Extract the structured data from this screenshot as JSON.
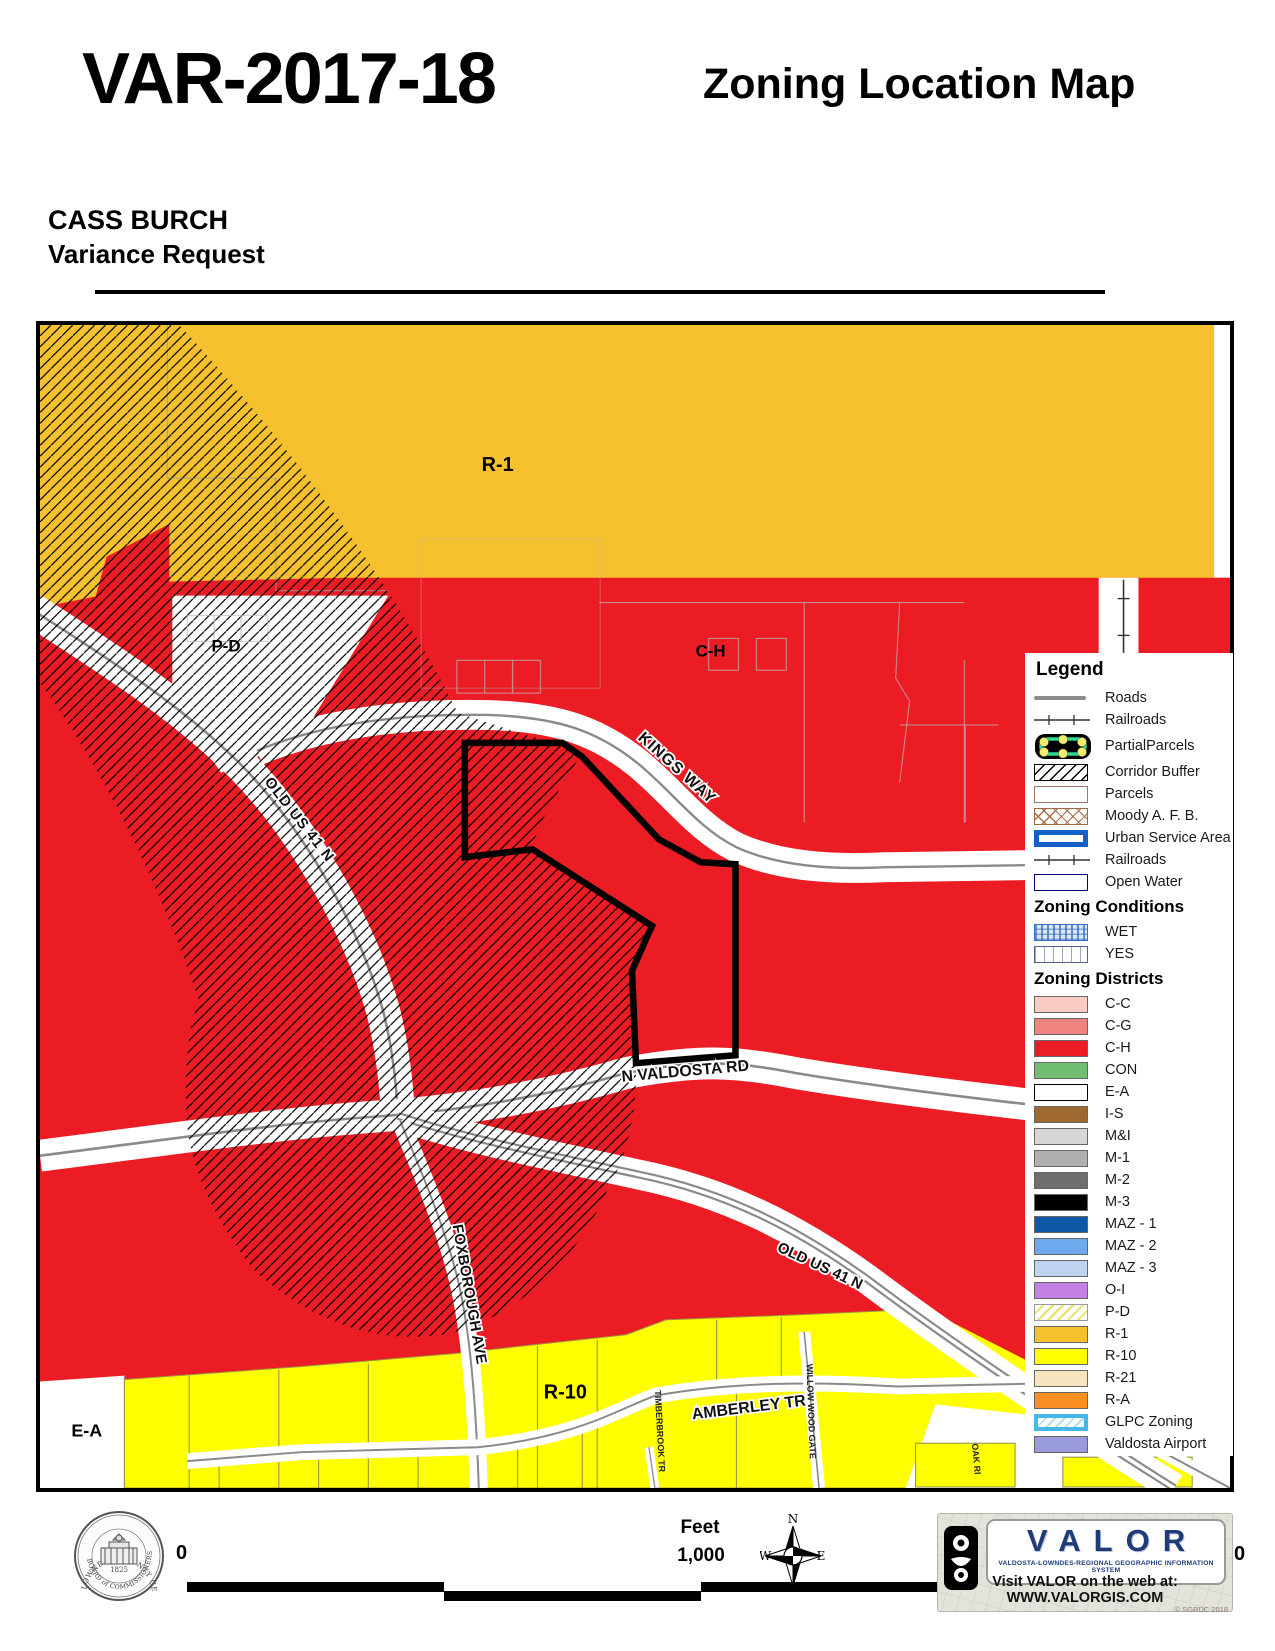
{
  "header": {
    "case_number": "VAR-2017-18",
    "doc_title": "Zoning Location Map",
    "applicant": "CASS BURCH",
    "request_type": "Variance Request"
  },
  "map": {
    "labels": {
      "r1": "R-1",
      "ch": "C-H",
      "pd": "P-D",
      "r10": "R-10",
      "ea": "E-A",
      "old_us_41_upper": "OLD US 41 N",
      "kings_way": "KINGS WAY",
      "n_valdosta_rd": "N VALDOSTA RD",
      "old_us_41_lower": "OLD US 41 N",
      "foxborough_ave": "FOXBOROUGH AVE",
      "amberley_tr": "AMBERLEY TR",
      "willow_wood_gate": "WILLOW WOOD GATE",
      "timberbrook_tr": "TIMBERBROOK TR",
      "oak_ri": "OAK RI"
    },
    "colors": {
      "commercial_red": "#EC1C24",
      "r1_gold": "#F6C12E",
      "r10_yellow": "#FFFF00",
      "road_gray": "#8A8A8A",
      "parcel_outline": "#000000"
    }
  },
  "legend": {
    "title": "Legend",
    "overlay_items": [
      {
        "label": "Roads"
      },
      {
        "label": "Railroads"
      },
      {
        "label": "PartialParcels"
      },
      {
        "label": "Corridor Buffer"
      },
      {
        "label": "Parcels"
      },
      {
        "label": "Moody A. F. B."
      },
      {
        "label": "Urban Service Area"
      },
      {
        "label": "Railroads"
      },
      {
        "label": "Open Water"
      }
    ],
    "conditions_title": "Zoning Conditions",
    "conditions": [
      {
        "label": "WET"
      },
      {
        "label": "YES"
      }
    ],
    "districts_title": "Zoning Districts",
    "districts": [
      {
        "label": "C-C",
        "color": "#F8CCC3"
      },
      {
        "label": "C-G",
        "color": "#F0837E"
      },
      {
        "label": "C-H",
        "color": "#EC1C24"
      },
      {
        "label": "CON",
        "color": "#6FBE71"
      },
      {
        "label": "E-A",
        "color": "#FFFFFF"
      },
      {
        "label": "I-S",
        "color": "#9E6830"
      },
      {
        "label": "M&I",
        "color": "#D6D6D6"
      },
      {
        "label": "M-1",
        "color": "#B0B0B0"
      },
      {
        "label": "M-2",
        "color": "#6E6E6E"
      },
      {
        "label": "M-3",
        "color": "#000000"
      },
      {
        "label": "MAZ - 1",
        "color": "#0F58A8"
      },
      {
        "label": "MAZ - 2",
        "color": "#6EA9EE"
      },
      {
        "label": "MAZ - 3",
        "color": "#BED3F0"
      },
      {
        "label": "O-I",
        "color": "#C580E6"
      },
      {
        "label": "P-D",
        "color": "#FCFCD4"
      },
      {
        "label": "R-1",
        "color": "#F6C12E"
      },
      {
        "label": "R-10",
        "color": "#FFFF00"
      },
      {
        "label": "R-21",
        "color": "#F8E4BF"
      },
      {
        "label": "R-A",
        "color": "#F98F22"
      },
      {
        "label": "GLPC Zoning",
        "color": "#FFFFFF"
      },
      {
        "label": "Valdosta Airport",
        "color": "#9A9ADF"
      }
    ]
  },
  "footer": {
    "scale": {
      "zero": "0",
      "feet_label": "Feet",
      "mid_label": "1,000",
      "end_label": "0"
    },
    "compass": {
      "n": "N",
      "w": "W",
      "e": "E"
    },
    "seal": {
      "arc_top": "LOWNDES COUNTY GEORGIA",
      "arc_bottom": "BOARD of COMMISSIONERS",
      "year": "1825"
    },
    "valor": {
      "name": "VALOR",
      "tagline": "VALDOSTA-LOWNDES-REGIONAL GEOGRAPHIC INFORMATION SYSTEM",
      "web": "Visit VALOR on the web at: WWW.VALORGIS.COM",
      "copyright": "© SGRDC 2018"
    }
  }
}
